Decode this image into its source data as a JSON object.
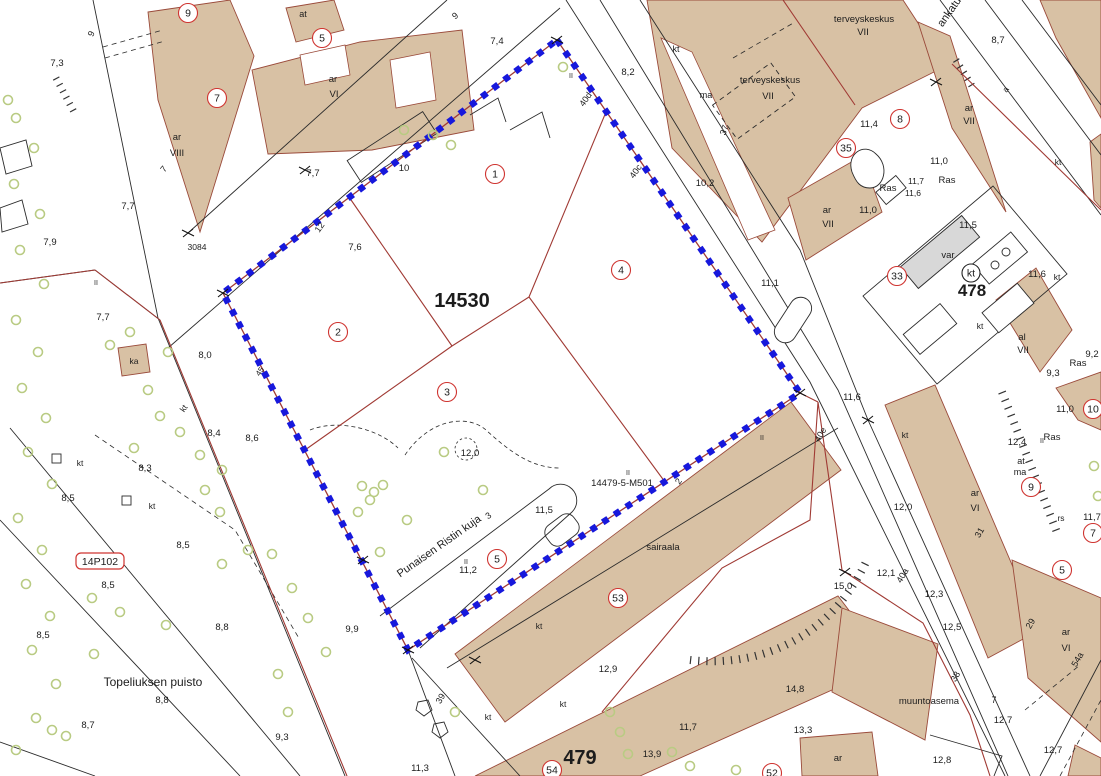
{
  "colors": {
    "building_fill": "#d8c1a4",
    "building_outline": "#9a4a3a",
    "parcel_red": "#a03a34",
    "red_text": "#cf3430",
    "boundary_blue": "#1718dc",
    "tree_green": "#b9cb83",
    "line_black": "#2b2b2b",
    "gray_fill": "#d8d8d8",
    "background": "#ffffff"
  },
  "parcel": {
    "main_plot_number": "14530",
    "boundary_marker": "14479-5-M501",
    "park_name": "Topeliuksen puisto",
    "street_name": "Punaisen Ristin kuja",
    "partial_street_name": "ankatu"
  },
  "labels": [
    {
      "t": "7,3",
      "x": 57,
      "y": 66
    },
    {
      "t": "9",
      "x": 94,
      "y": 35,
      "r": -65,
      "s": 9
    },
    {
      "t": "7,7",
      "x": 128,
      "y": 209
    },
    {
      "t": "7,9",
      "x": 50,
      "y": 245
    },
    {
      "t": "7,7",
      "x": 313,
      "y": 176
    },
    {
      "t": "7,6",
      "x": 355,
      "y": 250
    },
    {
      "t": "7,4",
      "x": 497,
      "y": 44
    },
    {
      "t": "9",
      "x": 457,
      "y": 18,
      "r": -40,
      "s": 9
    },
    {
      "t": "at",
      "x": 303,
      "y": 17,
      "s": 9
    },
    {
      "t": "ar",
      "x": 333,
      "y": 82
    },
    {
      "t": "VI",
      "x": 334,
      "y": 97
    },
    {
      "t": "ar",
      "x": 177,
      "y": 140
    },
    {
      "t": "VIII",
      "x": 177,
      "y": 156
    },
    {
      "t": "7",
      "x": 166,
      "y": 171,
      "r": -50,
      "s": 9
    },
    {
      "t": "3084",
      "x": 197,
      "y": 250,
      "s": 8.5
    },
    {
      "t": "8,0",
      "x": 205,
      "y": 358
    },
    {
      "t": "7,7",
      "x": 103,
      "y": 320
    },
    {
      "t": "ka",
      "x": 134,
      "y": 364,
      "s": 8.5
    },
    {
      "t": "kt",
      "x": 186,
      "y": 410,
      "r": -55,
      "s": 8.5
    },
    {
      "t": "8,4",
      "x": 214,
      "y": 436
    },
    {
      "t": "8,6",
      "x": 252,
      "y": 441
    },
    {
      "t": "8,3",
      "x": 145,
      "y": 471
    },
    {
      "t": "8,5",
      "x": 68,
      "y": 501
    },
    {
      "t": "kt",
      "x": 80,
      "y": 466,
      "s": 8.5
    },
    {
      "t": "kt",
      "x": 152,
      "y": 509,
      "s": 8.5
    },
    {
      "t": "8,5",
      "x": 108,
      "y": 588
    },
    {
      "t": "8,5",
      "x": 183,
      "y": 548
    },
    {
      "t": "Topeliuksen puisto",
      "x": 153,
      "y": 686,
      "s": 12
    },
    {
      "t": "8,8",
      "x": 162,
      "y": 703
    },
    {
      "t": "8,8",
      "x": 222,
      "y": 630
    },
    {
      "t": "8,7",
      "x": 88,
      "y": 728
    },
    {
      "t": "8,5",
      "x": 43,
      "y": 638
    },
    {
      "t": "9,3",
      "x": 282,
      "y": 740
    },
    {
      "t": "9,9",
      "x": 352,
      "y": 632
    },
    {
      "t": "12",
      "x": 322,
      "y": 229,
      "r": -55,
      "s": 9
    },
    {
      "t": "10",
      "x": 404,
      "y": 171
    },
    {
      "t": "40d",
      "x": 588,
      "y": 101,
      "r": -55,
      "s": 9
    },
    {
      "t": "40c",
      "x": 638,
      "y": 173,
      "r": -55,
      "s": 9
    },
    {
      "t": "8,2",
      "x": 628,
      "y": 75
    },
    {
      "t": "14530",
      "x": 462,
      "y": 307,
      "s": 20,
      "w": 1
    },
    {
      "t": "12,0",
      "x": 470,
      "y": 456
    },
    {
      "t": "Punaisen Ristin kuja",
      "x": 441,
      "y": 549,
      "s": 11,
      "r": -35
    },
    {
      "t": "3",
      "x": 490,
      "y": 518,
      "s": 9,
      "r": -35
    },
    {
      "t": "11,5",
      "x": 544,
      "y": 513
    },
    {
      "t": "11,2",
      "x": 468,
      "y": 573
    },
    {
      "t": "14479-5-M501",
      "x": 622,
      "y": 486,
      "c": "red",
      "s": 9.5
    },
    {
      "t": "2",
      "x": 681,
      "y": 483,
      "r": -55,
      "s": 9
    },
    {
      "t": "45",
      "x": 262,
      "y": 373,
      "r": -55,
      "s": 8
    },
    {
      "t": "sairaala",
      "x": 663,
      "y": 550
    },
    {
      "t": "kt",
      "x": 539,
      "y": 629,
      "s": 8.5
    },
    {
      "t": "kt",
      "x": 563,
      "y": 707,
      "s": 8.5
    },
    {
      "t": "kt",
      "x": 488,
      "y": 720,
      "s": 8.5
    },
    {
      "t": "12,9",
      "x": 608,
      "y": 672
    },
    {
      "t": "479",
      "x": 580,
      "y": 764,
      "s": 20,
      "w": 1
    },
    {
      "t": "13,9",
      "x": 652,
      "y": 757
    },
    {
      "t": "11,7",
      "x": 688,
      "y": 730
    },
    {
      "t": "11,3",
      "x": 420,
      "y": 771
    },
    {
      "t": "39",
      "x": 443,
      "y": 700,
      "r": -60,
      "s": 9
    },
    {
      "t": "14,8",
      "x": 795,
      "y": 692
    },
    {
      "t": "13,3",
      "x": 803,
      "y": 733
    },
    {
      "t": "15,0",
      "x": 843,
      "y": 589
    },
    {
      "t": "muuntoasema",
      "x": 929,
      "y": 704
    },
    {
      "t": "12,8",
      "x": 942,
      "y": 763
    },
    {
      "t": "12,7",
      "x": 1003,
      "y": 723
    },
    {
      "t": "12,7",
      "x": 1053,
      "y": 753
    },
    {
      "t": "7",
      "x": 994,
      "y": 703,
      "s": 9
    },
    {
      "t": "12,1",
      "x": 886,
      "y": 576
    },
    {
      "t": "40a",
      "x": 905,
      "y": 577,
      "r": -60,
      "s": 9
    },
    {
      "t": "12,3",
      "x": 934,
      "y": 597
    },
    {
      "t": "12,5",
      "x": 952,
      "y": 630
    },
    {
      "t": "38",
      "x": 958,
      "y": 678,
      "r": -60,
      "s": 9
    },
    {
      "t": "29",
      "x": 1033,
      "y": 625,
      "r": -60,
      "s": 9
    },
    {
      "t": "ar",
      "x": 1066,
      "y": 635
    },
    {
      "t": "VI",
      "x": 1066,
      "y": 651
    },
    {
      "t": "54a",
      "x": 1080,
      "y": 661,
      "r": -60,
      "s": 9
    },
    {
      "t": "ar",
      "x": 838,
      "y": 761
    },
    {
      "t": "11,1",
      "x": 770,
      "y": 286
    },
    {
      "t": "11,6",
      "x": 852,
      "y": 400
    },
    {
      "t": "12,0",
      "x": 903,
      "y": 510
    },
    {
      "t": "kt",
      "x": 905,
      "y": 438,
      "s": 8.5
    },
    {
      "t": "40e",
      "x": 823,
      "y": 436,
      "r": -60,
      "s": 9
    },
    {
      "t": "terveyskeskus",
      "x": 864,
      "y": 22
    },
    {
      "t": "VII",
      "x": 863,
      "y": 35
    },
    {
      "t": "terveyskeskus",
      "x": 770,
      "y": 83
    },
    {
      "t": "VII",
      "x": 768,
      "y": 99
    },
    {
      "t": "ma",
      "x": 706,
      "y": 98,
      "s": 9
    },
    {
      "t": "kt",
      "x": 676,
      "y": 52,
      "s": 9
    },
    {
      "t": "37",
      "x": 727,
      "y": 131,
      "r": -70,
      "s": 9
    },
    {
      "t": "10,2",
      "x": 705,
      "y": 186
    },
    {
      "t": "11,4",
      "x": 869,
      "y": 127
    },
    {
      "t": "11,0",
      "x": 868,
      "y": 213
    },
    {
      "t": "11,0",
      "x": 939,
      "y": 164
    },
    {
      "t": "Ras",
      "x": 947,
      "y": 183,
      "c": "red"
    },
    {
      "t": "Ras",
      "x": 888,
      "y": 191,
      "c": "red"
    },
    {
      "t": "11,7",
      "x": 916,
      "y": 184,
      "s": 8.5
    },
    {
      "t": "11,6",
      "x": 913,
      "y": 196,
      "s": 8.5
    },
    {
      "t": "ar",
      "x": 827,
      "y": 213
    },
    {
      "t": "VII",
      "x": 828,
      "y": 227
    },
    {
      "t": "8,7",
      "x": 998,
      "y": 43
    },
    {
      "t": "ankatu",
      "x": 952,
      "y": 14,
      "r": -55,
      "s": 11
    },
    {
      "t": "a",
      "x": 1008,
      "y": 91,
      "r": -55,
      "s": 8.5
    },
    {
      "t": "ar",
      "x": 969,
      "y": 111
    },
    {
      "t": "VII",
      "x": 969,
      "y": 124
    },
    {
      "t": "11,5",
      "x": 968,
      "y": 228
    },
    {
      "t": "var",
      "x": 948,
      "y": 258
    },
    {
      "t": "478",
      "x": 972,
      "y": 296,
      "s": 17,
      "w": 1
    },
    {
      "t": "11,6",
      "x": 1037,
      "y": 277
    },
    {
      "t": "kt",
      "x": 1057,
      "y": 280,
      "s": 8.5
    },
    {
      "t": "kt",
      "x": 1058,
      "y": 165,
      "s": 8.5
    },
    {
      "t": "kt",
      "x": 980,
      "y": 329,
      "s": 8.5
    },
    {
      "t": "al",
      "x": 1022,
      "y": 340
    },
    {
      "t": "VII",
      "x": 1023,
      "y": 353
    },
    {
      "t": "9,2",
      "x": 1092,
      "y": 357
    },
    {
      "t": "Ras",
      "x": 1078,
      "y": 366,
      "c": "red"
    },
    {
      "t": "9,3",
      "x": 1053,
      "y": 376
    },
    {
      "t": "11,0",
      "x": 1065,
      "y": 412
    },
    {
      "t": "12,4",
      "x": 1017,
      "y": 445
    },
    {
      "t": "Ras",
      "x": 1052,
      "y": 440,
      "c": "red"
    },
    {
      "t": "at",
      "x": 1021,
      "y": 464,
      "s": 9
    },
    {
      "t": "ma",
      "x": 1020,
      "y": 475,
      "s": 9
    },
    {
      "t": "ar",
      "x": 975,
      "y": 496
    },
    {
      "t": "VI",
      "x": 975,
      "y": 511
    },
    {
      "t": "31",
      "x": 982,
      "y": 534,
      "r": -60,
      "s": 9
    },
    {
      "t": "rs",
      "x": 1061,
      "y": 521,
      "s": 8.5
    },
    {
      "t": "11,7",
      "x": 1092,
      "y": 520
    },
    {
      "t": "II",
      "x": 571,
      "y": 78,
      "s": 7
    },
    {
      "t": "II",
      "x": 466,
      "y": 564,
      "s": 7
    },
    {
      "t": "II",
      "x": 762,
      "y": 440,
      "s": 7
    },
    {
      "t": "II",
      "x": 628,
      "y": 475,
      "s": 7
    },
    {
      "t": "II",
      "x": 1042,
      "y": 443,
      "s": 7
    },
    {
      "t": "II",
      "x": 96,
      "y": 285,
      "s": 7
    }
  ],
  "circled_numbers": [
    {
      "n": "9",
      "x": 188,
      "y": 13
    },
    {
      "n": "5",
      "x": 322,
      "y": 38
    },
    {
      "n": "7",
      "x": 217,
      "y": 98
    },
    {
      "n": "1",
      "x": 495,
      "y": 174
    },
    {
      "n": "2",
      "x": 338,
      "y": 332
    },
    {
      "n": "3",
      "x": 447,
      "y": 392
    },
    {
      "n": "4",
      "x": 621,
      "y": 270
    },
    {
      "n": "5",
      "x": 497,
      "y": 559
    },
    {
      "n": "35",
      "x": 846,
      "y": 148
    },
    {
      "n": "8",
      "x": 900,
      "y": 119
    },
    {
      "n": "33",
      "x": 897,
      "y": 276
    },
    {
      "n": "10",
      "x": 1093,
      "y": 409
    },
    {
      "n": "9",
      "x": 1031,
      "y": 487
    },
    {
      "n": "7",
      "x": 1093,
      "y": 533
    },
    {
      "n": "5",
      "x": 1062,
      "y": 570
    },
    {
      "n": "53",
      "x": 618,
      "y": 598
    },
    {
      "n": "54",
      "x": 552,
      "y": 770
    },
    {
      "n": "52",
      "x": 772,
      "y": 773
    },
    {
      "n": "kt",
      "x": 971,
      "y": 273,
      "c": "black",
      "rad": 9
    }
  ],
  "boxed_labels": [
    {
      "t": "14P102",
      "x": 100,
      "y": 561,
      "w": 48,
      "h": 16
    }
  ],
  "junction_marks": [
    [
      557,
      40
    ],
    [
      223,
      293
    ],
    [
      408,
      650
    ],
    [
      800,
      393
    ],
    [
      188,
      233
    ],
    [
      363,
      560
    ],
    [
      845,
      572
    ],
    [
      868,
      420
    ],
    [
      305,
      170
    ],
    [
      475,
      660
    ],
    [
      936,
      82
    ]
  ],
  "trees": [
    [
      16,
      118
    ],
    [
      34,
      148
    ],
    [
      14,
      184
    ],
    [
      40,
      214
    ],
    [
      20,
      250
    ],
    [
      44,
      284
    ],
    [
      16,
      320
    ],
    [
      38,
      352
    ],
    [
      22,
      388
    ],
    [
      46,
      418
    ],
    [
      28,
      452
    ],
    [
      52,
      484
    ],
    [
      18,
      518
    ],
    [
      42,
      550
    ],
    [
      26,
      584
    ],
    [
      50,
      616
    ],
    [
      32,
      650
    ],
    [
      56,
      684
    ],
    [
      36,
      718
    ],
    [
      16,
      750
    ],
    [
      8,
      100
    ],
    [
      110,
      345
    ],
    [
      130,
      332
    ],
    [
      168,
      352
    ],
    [
      148,
      390
    ],
    [
      160,
      416
    ],
    [
      180,
      432
    ],
    [
      134,
      448
    ],
    [
      200,
      455
    ],
    [
      222,
      470
    ],
    [
      205,
      490
    ],
    [
      220,
      512
    ],
    [
      222,
      564
    ],
    [
      248,
      550
    ],
    [
      272,
      554
    ],
    [
      292,
      588
    ],
    [
      308,
      618
    ],
    [
      326,
      652
    ],
    [
      278,
      674
    ],
    [
      288,
      712
    ],
    [
      92,
      598
    ],
    [
      120,
      612
    ],
    [
      166,
      625
    ],
    [
      94,
      654
    ],
    [
      52,
      730
    ],
    [
      66,
      736
    ],
    [
      362,
      486
    ],
    [
      374,
      492
    ],
    [
      383,
      485
    ],
    [
      370,
      500
    ],
    [
      444,
      452
    ],
    [
      483,
      490
    ],
    [
      407,
      520
    ],
    [
      358,
      512
    ],
    [
      380,
      552
    ],
    [
      563,
      67
    ],
    [
      433,
      135
    ],
    [
      451,
      145
    ],
    [
      404,
      130
    ],
    [
      1094,
      466
    ],
    [
      1098,
      496
    ],
    [
      455,
      712
    ],
    [
      610,
      712
    ],
    [
      620,
      732
    ],
    [
      628,
      754
    ],
    [
      672,
      752
    ],
    [
      690,
      766
    ],
    [
      736,
      770
    ]
  ]
}
